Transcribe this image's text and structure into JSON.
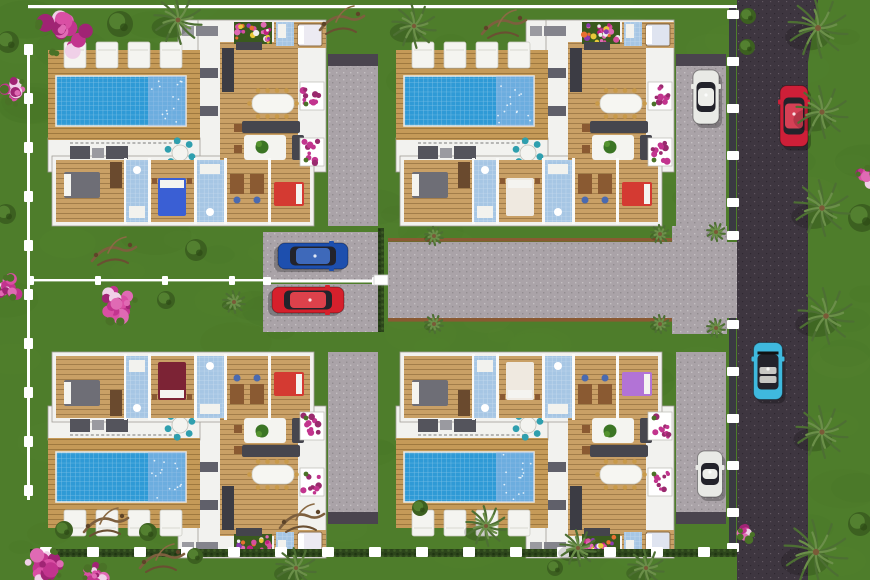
{
  "scene": {
    "description": "aerial-3d-site-plan-four-villas-with-pools",
    "canvas": {
      "w": 870,
      "h": 580
    },
    "palette": {
      "grass": "#4e7d2b",
      "grassDark": "#3e6a1f",
      "grassLight": "#5d8d35",
      "asphalt": "#3e3640",
      "concrete": "#aaa3a8",
      "deck": "#c59a58",
      "floor": "#c9a066",
      "wall": "#f2f2ef",
      "terrace": "#e9e9e4",
      "pool": "#2f9ad6",
      "poolShimmer": "#a9bfe8",
      "hedge": "#2c451b",
      "fence": "#ffffff",
      "wallDark": "#3a3a42",
      "teal": "#2f9fae",
      "sofaDark": "#46464e",
      "wood": "#8a5a32",
      "palmFrond": "#6b8f49",
      "palmDark": "#4d6f33",
      "pink": "#c2348e",
      "pinkLight": "#e06ab4",
      "bush": "#3c6020",
      "bushLight": "#538030",
      "drift": "#7d5f3e"
    },
    "villas": [
      {
        "name": "villa-top-left",
        "x": 48,
        "y": 14,
        "flip": false,
        "beds": {
          "master": "#6e6e76",
          "mid": "#3a5fd4",
          "end": "#d43a32",
          "wing": "#eceaf2"
        }
      },
      {
        "name": "villa-top-right",
        "x": 396,
        "y": 14,
        "flip": false,
        "beds": {
          "master": "#6e6e76",
          "mid": "#efe9e0",
          "end": "#d43a32",
          "wing": "#dfe4f0"
        }
      },
      {
        "name": "villa-bottom-left",
        "x": 48,
        "y": 564,
        "flip": true,
        "beds": {
          "master": "#6e6e76",
          "mid": "#7c2335",
          "end": "#d43a32",
          "wing": "#eceaf2"
        }
      },
      {
        "name": "villa-bottom-right",
        "x": 396,
        "y": 564,
        "flip": true,
        "beds": {
          "master": "#6e6e76",
          "mid": "#efe9e0",
          "end": "#b273d6",
          "wing": "#dfe4f0"
        }
      }
    ],
    "cars": [
      {
        "name": "car-white-top-driveway",
        "color": "#e9eae6",
        "cx": 706,
        "cy": 97,
        "len": 54,
        "wid": 26,
        "angle": 0
      },
      {
        "name": "car-blue-left-driveway",
        "color": "#1d4fae",
        "cx": 313,
        "cy": 256,
        "len": 70,
        "wid": 26,
        "angle": 90
      },
      {
        "name": "car-red-left-driveway",
        "color": "#d6202c",
        "cx": 308,
        "cy": 300,
        "len": 72,
        "wid": 26,
        "angle": 90
      },
      {
        "name": "car-red-road",
        "color": "#ce1f38",
        "cx": 794,
        "cy": 116,
        "len": 61,
        "wid": 28,
        "angle": 0
      },
      {
        "name": "car-cyan-convertible-road",
        "color": "#3fb9de",
        "cx": 768,
        "cy": 371,
        "len": 57,
        "wid": 29,
        "angle": 0,
        "convertible": true
      },
      {
        "name": "car-white-bottom-driveway",
        "color": "#e9eae6",
        "cx": 710,
        "cy": 474,
        "len": 46,
        "wid": 25,
        "angle": 0
      }
    ],
    "roads": {
      "mainRoad": {
        "x": 737,
        "y": 0,
        "w": 73,
        "h": 580
      },
      "plaza": {
        "x": 388,
        "y": 242,
        "w": 349,
        "h": 76
      },
      "laneTop": {
        "x": 263,
        "y": 232,
        "w": 117,
        "h": 48
      },
      "laneBottom": {
        "x": 263,
        "y": 284,
        "w": 117,
        "h": 48
      },
      "connectorTop": {
        "x": 672,
        "y": 226,
        "w": 55,
        "h": 18
      },
      "connectorBottom": {
        "x": 672,
        "y": 316,
        "w": 55,
        "h": 18
      }
    },
    "palms": [
      {
        "x": 178,
        "y": 20,
        "r": 24
      },
      {
        "x": 414,
        "y": 26,
        "r": 22
      },
      {
        "x": 818,
        "y": 28,
        "r": 30
      },
      {
        "x": 822,
        "y": 112,
        "r": 26
      },
      {
        "x": 822,
        "y": 208,
        "r": 28
      },
      {
        "x": 826,
        "y": 316,
        "r": 28
      },
      {
        "x": 822,
        "y": 432,
        "r": 26
      },
      {
        "x": 816,
        "y": 552,
        "r": 32
      },
      {
        "x": 296,
        "y": 568,
        "r": 20
      },
      {
        "x": 486,
        "y": 526,
        "r": 20
      },
      {
        "x": 578,
        "y": 548,
        "r": 18
      },
      {
        "x": 646,
        "y": 568,
        "r": 18
      },
      {
        "x": 434,
        "y": 236,
        "r": 9
      },
      {
        "x": 660,
        "y": 234,
        "r": 9
      },
      {
        "x": 716,
        "y": 232,
        "r": 9
      },
      {
        "x": 434,
        "y": 324,
        "r": 9
      },
      {
        "x": 660,
        "y": 324,
        "r": 9
      },
      {
        "x": 716,
        "y": 328,
        "r": 9
      },
      {
        "x": 234,
        "y": 302,
        "r": 11
      }
    ],
    "flowerTrees": [
      {
        "x": 62,
        "y": 30,
        "r": 30
      },
      {
        "x": 16,
        "y": 92,
        "r": 15
      },
      {
        "x": 116,
        "y": 303,
        "r": 24
      },
      {
        "x": 8,
        "y": 288,
        "r": 13
      },
      {
        "x": 44,
        "y": 566,
        "r": 22
      },
      {
        "x": 96,
        "y": 576,
        "r": 14
      },
      {
        "x": 866,
        "y": 176,
        "r": 10
      },
      {
        "x": 746,
        "y": 534,
        "r": 8
      }
    ],
    "bushes": [
      {
        "x": 120,
        "y": 24,
        "r": 13
      },
      {
        "x": 196,
        "y": 250,
        "r": 11
      },
      {
        "x": 166,
        "y": 300,
        "r": 9
      },
      {
        "x": 64,
        "y": 530,
        "r": 9
      },
      {
        "x": 148,
        "y": 532,
        "r": 9
      },
      {
        "x": 748,
        "y": 16,
        "r": 8
      },
      {
        "x": 747,
        "y": 47,
        "r": 8
      },
      {
        "x": 862,
        "y": 218,
        "r": 14
      },
      {
        "x": 860,
        "y": 524,
        "r": 12
      },
      {
        "x": 8,
        "y": 42,
        "r": 11
      },
      {
        "x": 6,
        "y": 214,
        "r": 10
      },
      {
        "x": 420,
        "y": 508,
        "r": 8
      },
      {
        "x": 195,
        "y": 556,
        "r": 8
      },
      {
        "x": 555,
        "y": 568,
        "r": 8
      }
    ],
    "driftwood": [
      {
        "x": 112,
        "y": 253
      },
      {
        "x": 300,
        "y": 520
      },
      {
        "x": 104,
        "y": 524
      },
      {
        "x": 502,
        "y": 26
      },
      {
        "x": 340,
        "y": 22
      },
      {
        "x": 160,
        "y": 560
      }
    ]
  }
}
